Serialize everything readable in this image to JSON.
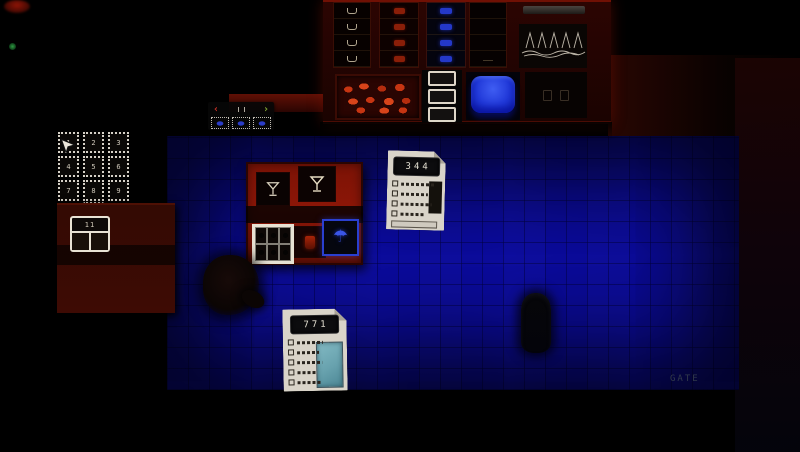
{
  "scene": {
    "description": "Top-down pixel-art bar room with blue tiled floor, red counters and back-bar shelves",
    "colors": {
      "floor_blue": "#0c0ca6",
      "wall_red": "#7c1306",
      "accent_blue": "#2438c8",
      "paper": "#d9d4c9",
      "photo_teal": "#68a2ae"
    }
  },
  "tickets": {
    "first": {
      "number": "344"
    },
    "second": {
      "number": "771"
    }
  },
  "keypad": {
    "keys": [
      "1",
      "2",
      "3",
      "4",
      "5",
      "6",
      "7",
      "8",
      "9"
    ],
    "cancel": "×",
    "zero": "0"
  },
  "selector": {
    "prev": "‹",
    "next": "›"
  },
  "desk_card": {
    "label": "11"
  },
  "stations": {
    "umbrella_glyph": "☂"
  },
  "floor_sign": {
    "label": "GATE"
  }
}
